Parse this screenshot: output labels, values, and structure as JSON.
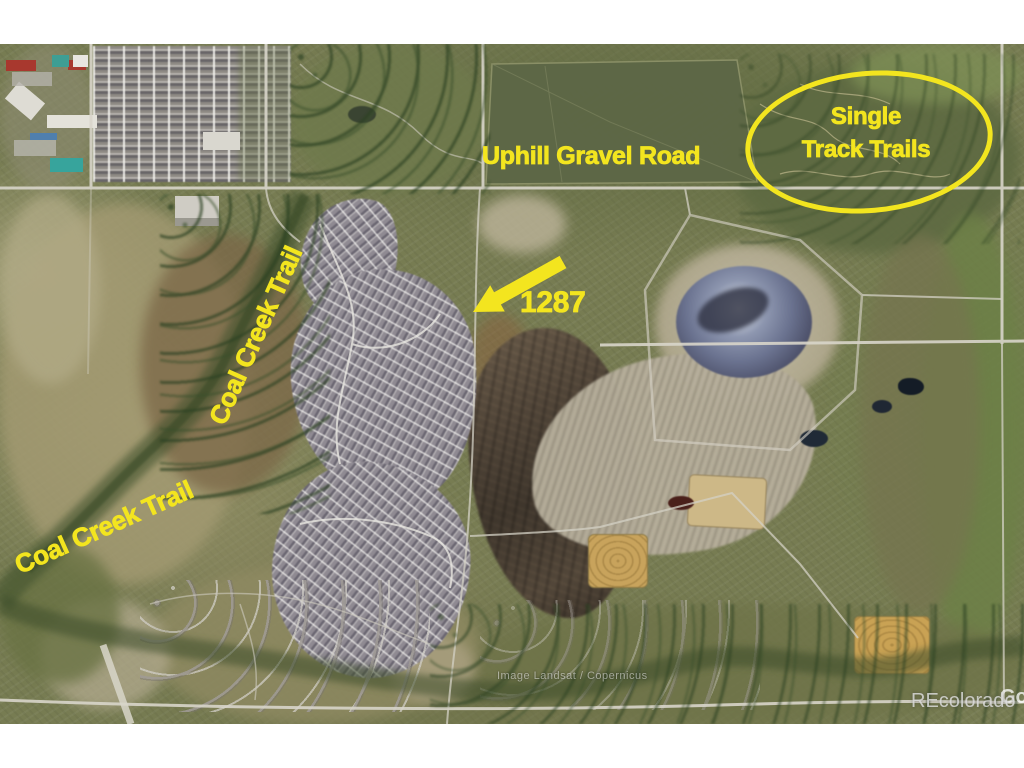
{
  "map": {
    "type": "satellite-aerial-listing-photo",
    "annotation_color": "#f3e51f",
    "annotations": {
      "road_label": "Uphill Gravel Road",
      "circled_area_line1": "Single",
      "circled_area_line2": "Track Trails",
      "arrow_label": "1287",
      "trail_label_upper": "Coal Creek Trail",
      "trail_label_lower": "Coal Creek Trail"
    },
    "watermarks": {
      "imagery_credit": "Image Landsat / Copernicus",
      "brand": "REcolorado",
      "partial_logo": "Goo"
    }
  }
}
